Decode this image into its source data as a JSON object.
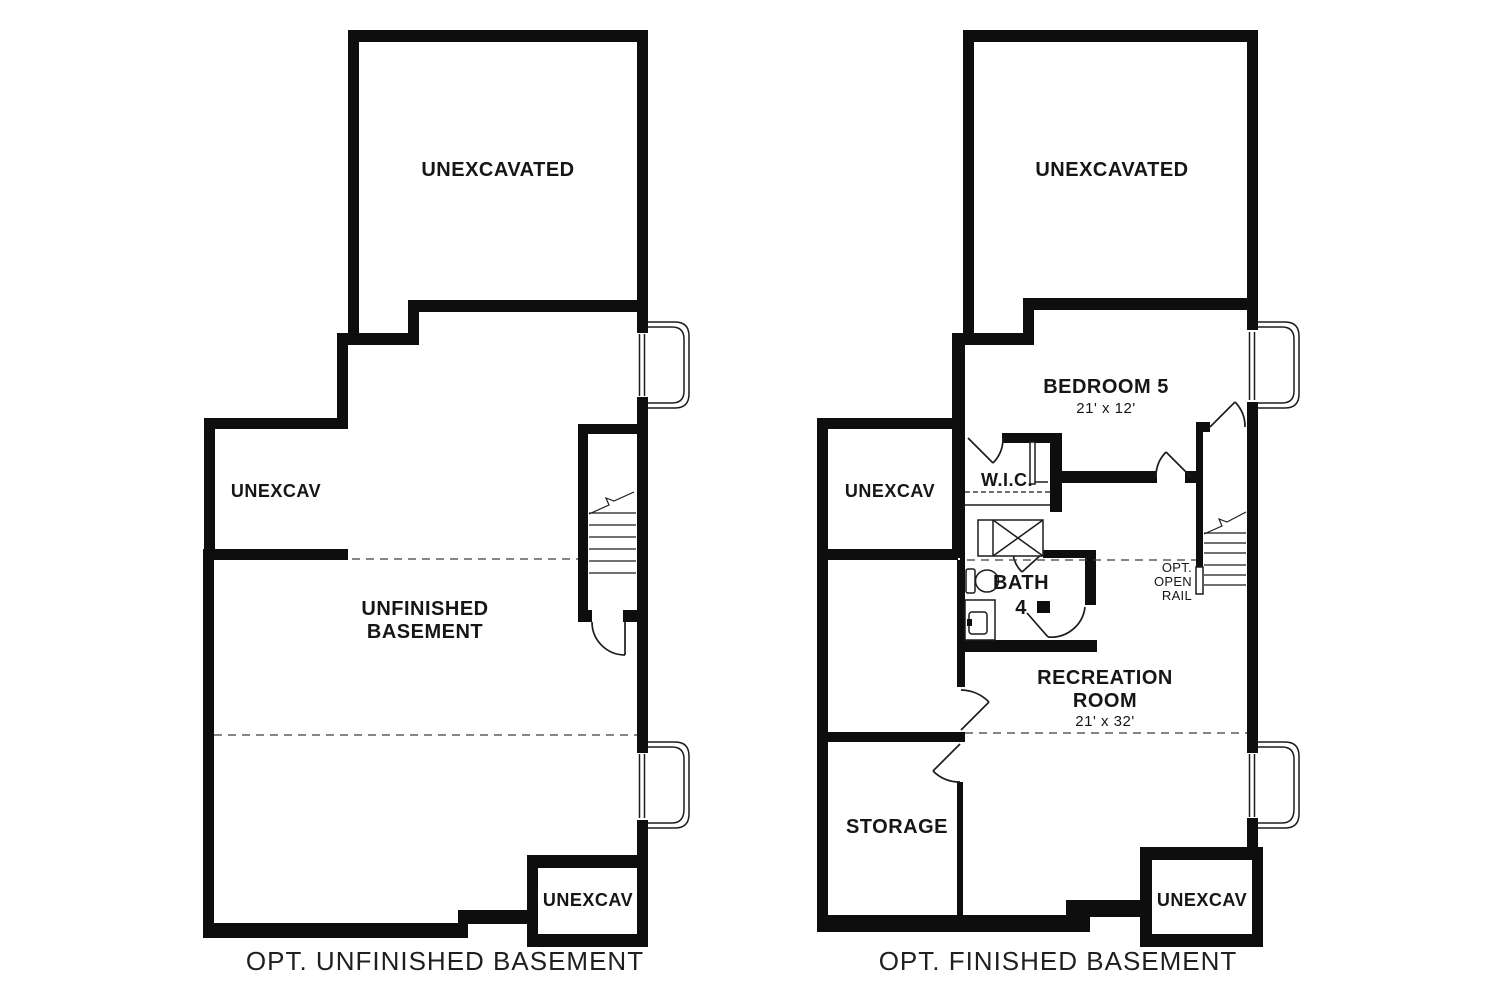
{
  "colors": {
    "background": "#ffffff",
    "wall": "#0e0e0e",
    "line": "#1c1c1c",
    "dashed": "#3c3c3c",
    "label": "#161616",
    "caption": "#1f1f1f"
  },
  "left_plan": {
    "caption": "OPT. UNFINISHED BASEMENT",
    "rooms": {
      "unexcavated_top": "UNEXCAVATED",
      "unexcav_left": "UNEXCAV",
      "main": {
        "line1": "UNFINISHED",
        "line2": "BASEMENT"
      },
      "unexcav_bottom": "UNEXCAV"
    }
  },
  "right_plan": {
    "caption": "OPT. FINISHED BASEMENT",
    "rooms": {
      "unexcavated_top": "UNEXCAVATED",
      "unexcav_left": "UNEXCAV",
      "bedroom": {
        "name": "BEDROOM 5",
        "dims": "21' x 12'"
      },
      "wic": "W.I.C.",
      "bath": {
        "line1": "BATH",
        "line2": "4"
      },
      "recreation": {
        "line1": "RECREATION",
        "line2": "ROOM",
        "dims": "21' x 32'"
      },
      "storage": "STORAGE",
      "unexcav_bottom": "UNEXCAV",
      "open_rail": {
        "line1": "OPT.",
        "line2": "OPEN",
        "line3": "RAIL"
      }
    }
  }
}
